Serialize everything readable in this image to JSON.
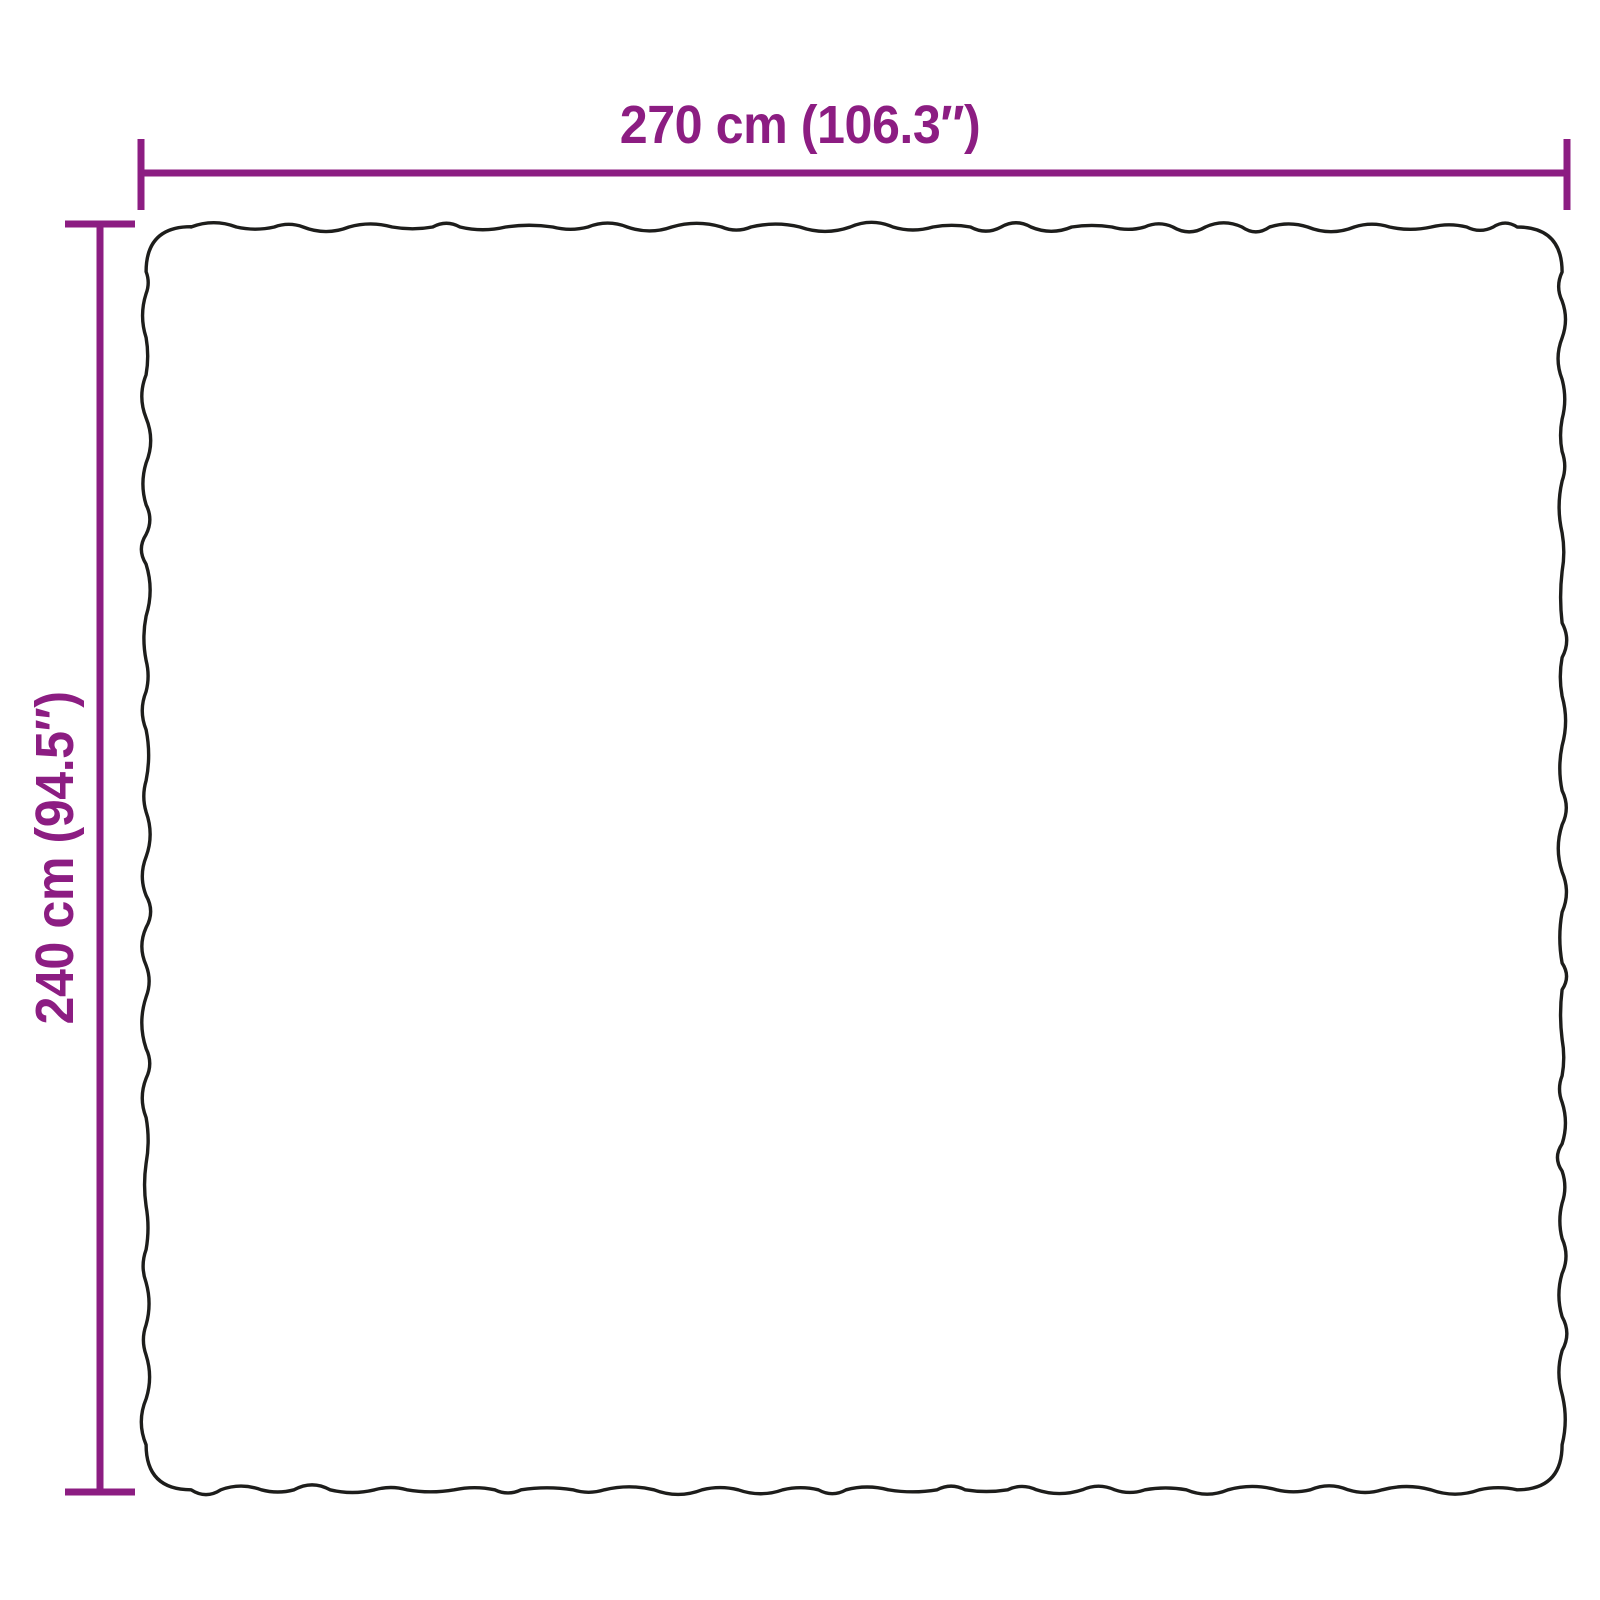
{
  "diagram": {
    "type": "product-dimension-diagram",
    "width_label": "270 cm (106.3″)",
    "height_label": "240 cm (94.5″)"
  },
  "colors": {
    "dimension_accent": "#8C1D82",
    "product_outline": "#1D1D1B",
    "background": "#FFFFFF"
  }
}
